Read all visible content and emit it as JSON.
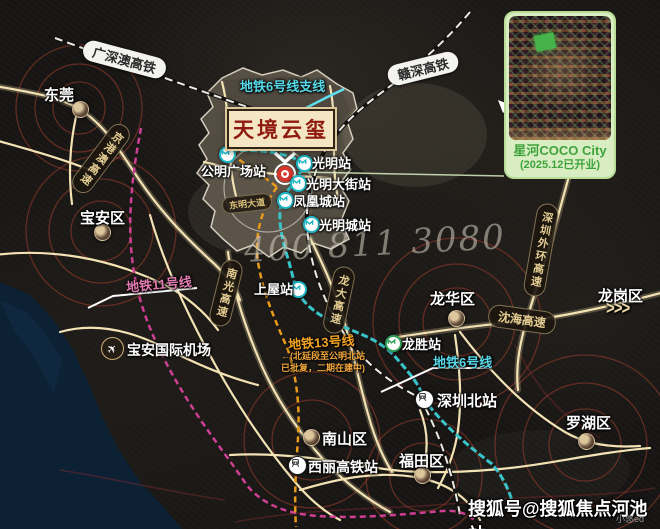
{
  "map": {
    "project": {
      "name": "天境云玺"
    },
    "phone": "400 811 3080",
    "rails": {
      "gsa": "广深澳高铁",
      "gs": "赣深高铁"
    },
    "metro": {
      "line6_branch": "地铁6号线支线",
      "line6": "地铁6号线",
      "line11": "地铁11号线",
      "line13": "地铁13号线",
      "line13_note1": "←(北延段至公明北站",
      "line13_note2": "已批复，二期在建中)"
    },
    "highways": {
      "jinggangao": "京港澳高速",
      "nanguang": "南光高速",
      "longda": "龙大高速",
      "shenhai": "沈海高速",
      "waihuan": "深圳外环高速"
    },
    "roads": {
      "dongming": "东明大道"
    },
    "districts": {
      "dongguan": "东莞",
      "baoan": "宝安区",
      "longhua": "龙华区",
      "longgang": "龙岗区",
      "luohu": "罗湖区",
      "nanshan": "南山区",
      "futian": "福田区"
    },
    "stations": {
      "gongming_plaza": "公明广场站",
      "guangming": "光明站",
      "guangming_dajie": "光明大街站",
      "fenghuangcheng": "凤凰城站",
      "guangmingcheng": "光明城站",
      "shangwu": "上屋站",
      "longsheng": "龙胜站",
      "shenzhenbei": "深圳北站",
      "xili": "西丽高铁站"
    },
    "poi": {
      "airport": "宝安国际机场"
    },
    "arrows": ">>>",
    "inset": {
      "title": "星河COCO City",
      "status": "(2025.12已开业)"
    },
    "watermark": {
      "main": "搜狐号@搜狐焦点河池站",
      "small": "小悠ed"
    }
  }
}
